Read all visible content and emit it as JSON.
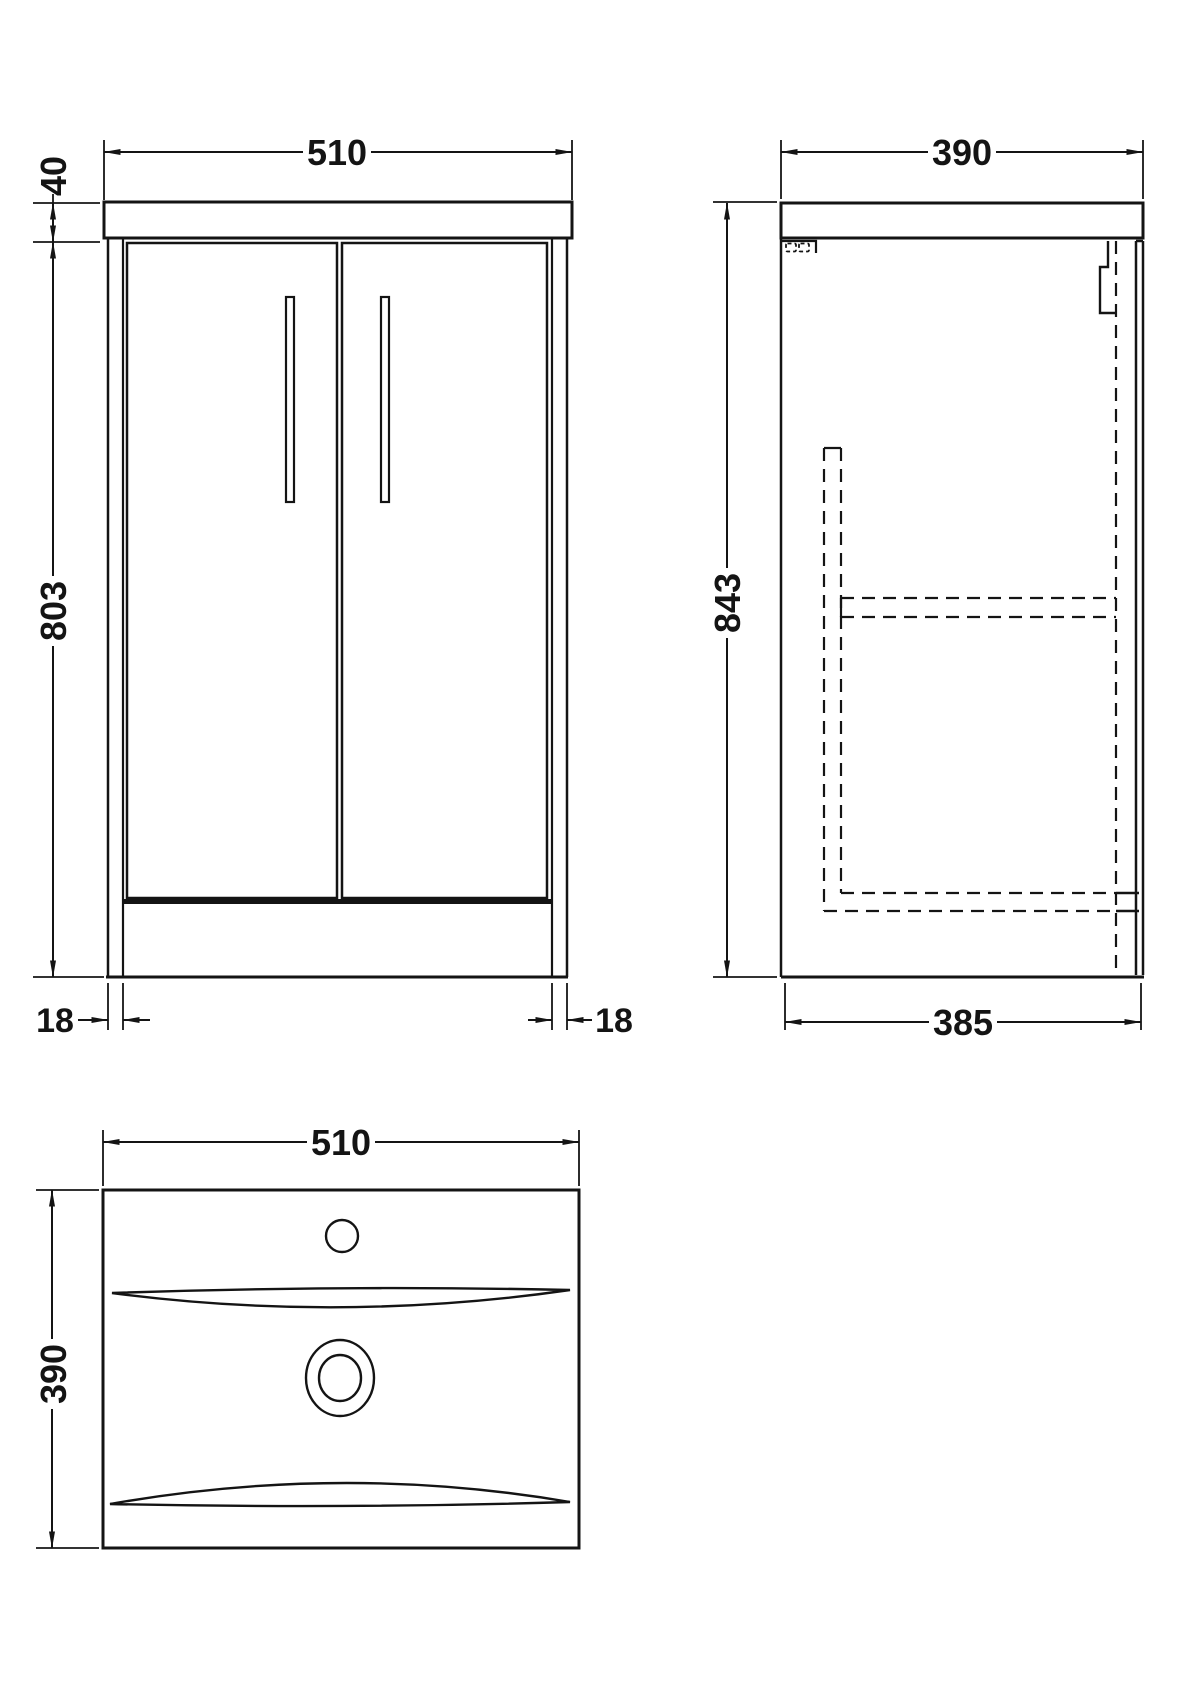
{
  "title": "vanity-unit-technical-drawing",
  "colors": {
    "background": "#ffffff",
    "line": "#141414"
  },
  "views": {
    "front_elevation": {
      "width_mm": "510",
      "worktop_height_mm": "40",
      "cabinet_height_mm": "803",
      "left_leg_mm": "18",
      "right_leg_mm": "18"
    },
    "side_elevation": {
      "depth_mm": "390",
      "overall_height_mm": "843",
      "cabinet_depth_mm": "385"
    },
    "basin_plan": {
      "width_mm": "510",
      "depth_mm": "390"
    }
  }
}
